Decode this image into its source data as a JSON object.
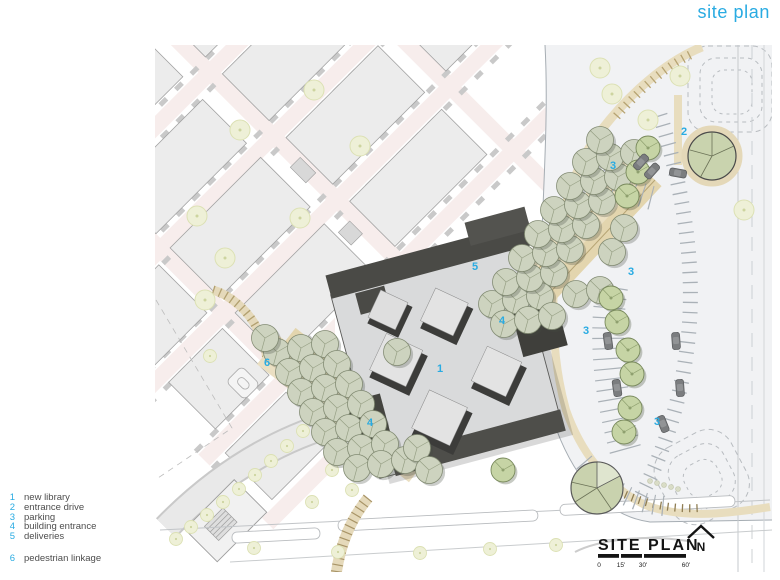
{
  "title": "site plan",
  "colors": {
    "accent": "#29ABE2",
    "library_roof": "#d9dadb",
    "library_dark": "#4a4a46",
    "tree_sage": "#cdd3bf",
    "tree_green": "#c6d4a5",
    "path_tan": "#e8ddbe",
    "street_pink": "#f7edec"
  },
  "legend": {
    "items": [
      {
        "num": "1",
        "label": "new library"
      },
      {
        "num": "2",
        "label": "entrance drive"
      },
      {
        "num": "3",
        "label": "parking"
      },
      {
        "num": "4",
        "label": "building entrance"
      },
      {
        "num": "5",
        "label": "deliveries"
      },
      {
        "num": "6",
        "label": "pedestrian linkage"
      }
    ]
  },
  "plan_markers": [
    {
      "text": "1",
      "refers_to": "new library"
    },
    {
      "text": "2",
      "refers_to": "entrance drive"
    },
    {
      "text": "3",
      "refers_to": "parking"
    },
    {
      "text": "3",
      "refers_to": "parking"
    },
    {
      "text": "3",
      "refers_to": "parking"
    },
    {
      "text": "3",
      "refers_to": "parking"
    },
    {
      "text": "4",
      "refers_to": "building entrance"
    },
    {
      "text": "4",
      "refers_to": "building entrance"
    },
    {
      "text": "5",
      "refers_to": "deliveries"
    },
    {
      "text": "6",
      "refers_to": "pedestrian linkage"
    }
  ],
  "titleblock": {
    "name": "SITE PLAN",
    "north_label": "N",
    "scale_ticks": [
      "0",
      "15'",
      "30'",
      "60'"
    ]
  }
}
